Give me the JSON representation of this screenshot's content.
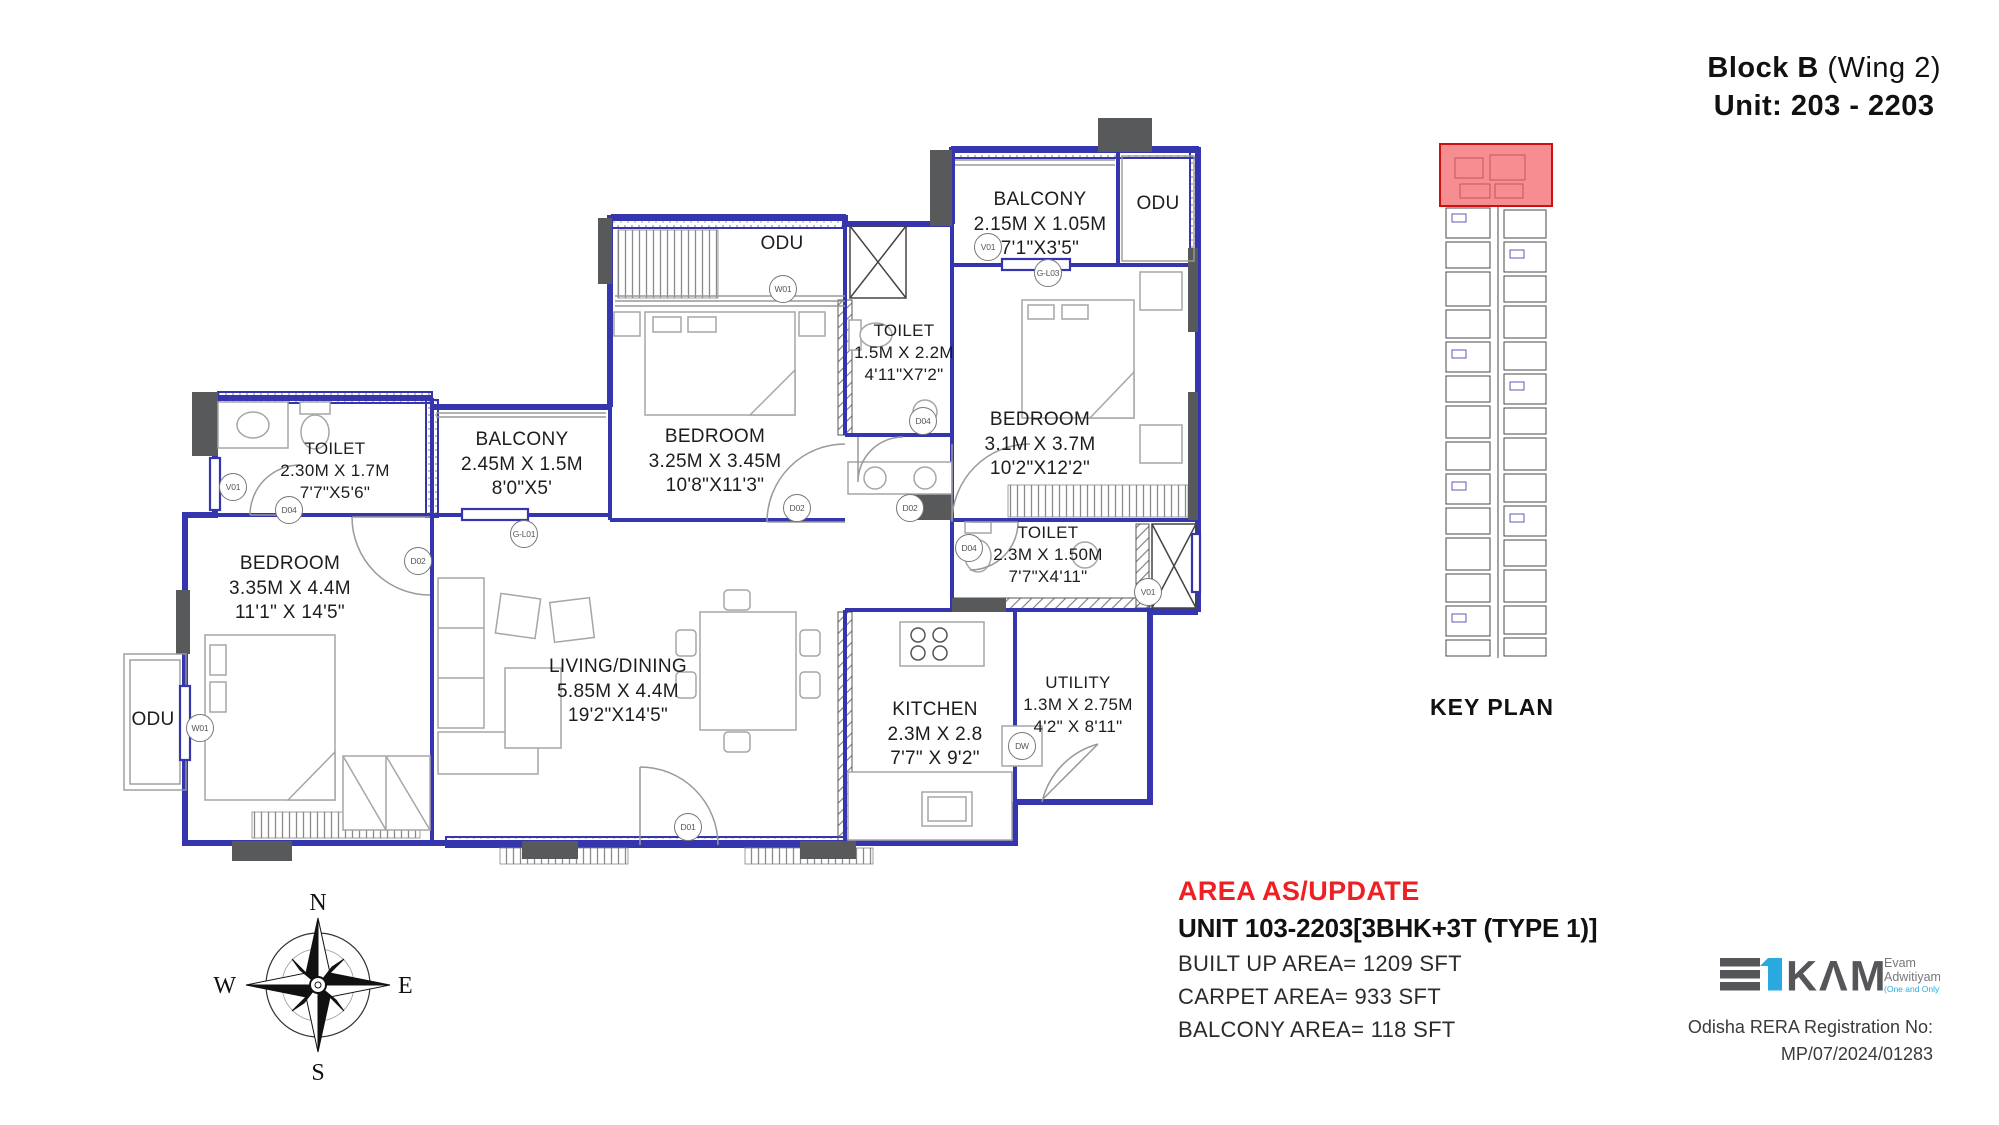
{
  "header": {
    "block_bold": "Block B",
    "wing": " (Wing 2)",
    "unit_line": "Unit: 203 - 2203"
  },
  "plan": {
    "rooms": [
      {
        "name": "BALCONY",
        "metric": "2.15M X 1.05M",
        "imperial": "7'1\"X3'5\""
      },
      {
        "name": "ODU"
      },
      {
        "name": "ODU"
      },
      {
        "name": "TOILET",
        "metric": "1.5M X 2.2M",
        "imperial": "4'11\"X7'2\""
      },
      {
        "name": "BEDROOM",
        "metric": "3.25M X 3.45M",
        "imperial": "10'8\"X11'3\""
      },
      {
        "name": "BEDROOM",
        "metric": "3.1M X 3.7M",
        "imperial": "10'2\"X12'2\""
      },
      {
        "name": "TOILET",
        "metric": "2.30M X 1.7M",
        "imperial": "7'7\"X5'6\""
      },
      {
        "name": "BALCONY",
        "metric": "2.45M X 1.5M",
        "imperial": "8'0\"X5'"
      },
      {
        "name": "BEDROOM",
        "metric": "3.35M X 4.4M",
        "imperial": "11'1\" X 14'5\""
      },
      {
        "name": "LIVING/DINING",
        "metric": "5.85M X 4.4M",
        "imperial": "19'2\"X14'5\""
      },
      {
        "name": "TOILET",
        "metric": "2.3M X 1.50M",
        "imperial": "7'7\"X4'11\""
      },
      {
        "name": "KITCHEN",
        "metric": "2.3M X 2.8",
        "imperial": "7'7\" X 9'2\""
      },
      {
        "name": "UTILITY",
        "metric": "1.3M X 2.75M",
        "imperial": "4'2\" X 8'11\""
      },
      {
        "name": "ODU"
      }
    ],
    "tags": [
      "W01",
      "V01",
      "G-L03",
      "D04",
      "D02",
      "D02",
      "V01",
      "D04",
      "G-L01",
      "D02",
      "D04",
      "V01",
      "W01",
      "D01",
      "DW"
    ]
  },
  "key_plan": {
    "label": "KEY PLAN"
  },
  "compass": {
    "n": "N",
    "e": "E",
    "s": "S",
    "w": "W"
  },
  "area_info": {
    "heading": "AREA AS/UPDATE",
    "unit_line": "UNIT 103-2203[3BHK+3T (TYPE 1)]",
    "built_up": "BUILT UP AREA= 1209 SFT",
    "carpet": "CARPET AREA= 933 SFT",
    "balcony": "BALCONY AREA= 118 SFT"
  },
  "branding": {
    "logo_text": "KΛM",
    "tagline_line1": "Evam",
    "tagline_line2": "Adwitiyam",
    "tagline_line3": "(One and Only)",
    "rera_line1": "Odisha RERA Registration No:",
    "rera_line2": "MP/07/2024/01283"
  },
  "colors": {
    "wall_blue": "#3535ae",
    "wall_gray": "#58595b",
    "highlight_red": "#ed1c24",
    "accent_red": "#ed2024",
    "logo_cyan": "#2aa9e0",
    "logo_gray": "#55565a"
  }
}
